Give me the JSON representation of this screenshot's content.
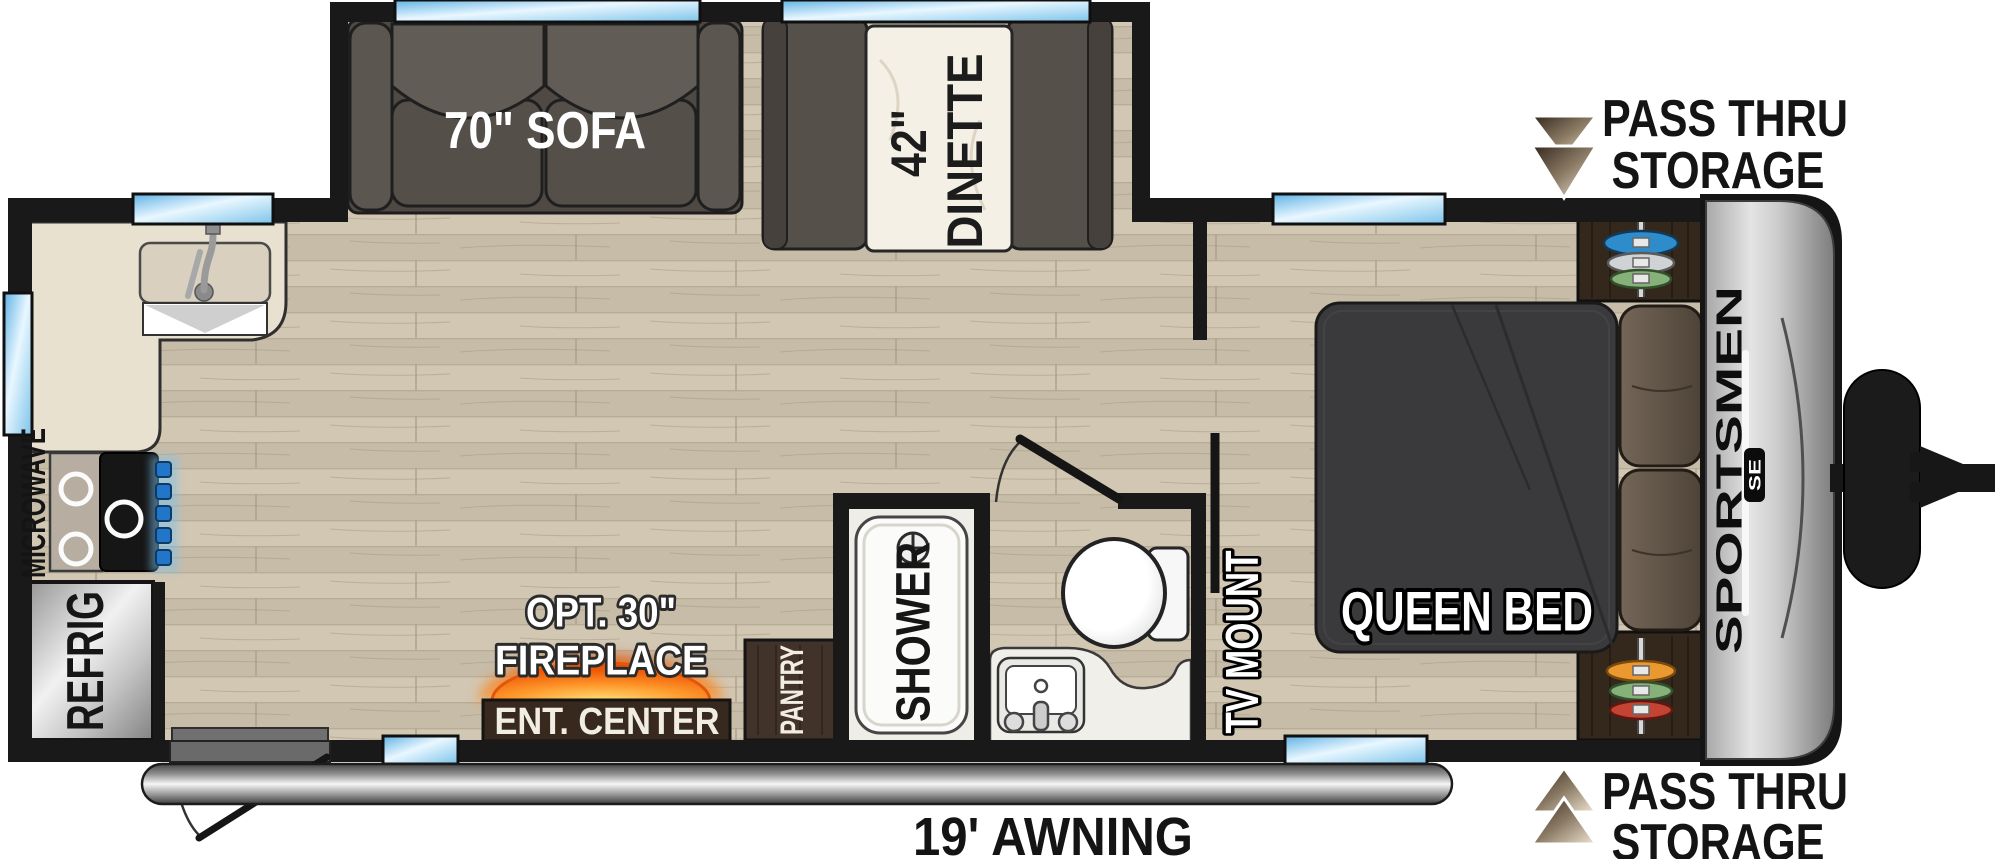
{
  "title": "Sportsmen SE Travel Trailer Floorplan",
  "labels": {
    "sofa": "70\" SOFA",
    "dinette_size": "42\"",
    "dinette_name": "DINETTE",
    "pass_thru_top_line1": "PASS THRU",
    "pass_thru_top_line2": "STORAGE",
    "pass_thru_bottom_line1": "PASS THRU",
    "pass_thru_bottom_line2": "STORAGE",
    "queen_bed": "QUEEN BED",
    "tv_mount": "TV MOUNT",
    "shower": "SHOWER",
    "pantry": "PANTRY",
    "fireplace_opt": "OPT. 30\"",
    "fireplace": "FIREPLACE",
    "ent_center": "ENT. CENTER",
    "microwave": "MICROWAVE",
    "refrigerator": "REFRIG",
    "brand": "SPORTSMEN",
    "brand_badge": "SE",
    "awning": "19' AWNING"
  },
  "colors": {
    "wall": "#191919",
    "floor_base": "#cdc2ae",
    "window_blue": "#7cc3ea",
    "furniture_gray": "#55504a",
    "cabinet_brown": "#3a2c1f",
    "bed_charcoal": "#3a3a3c",
    "fire_accent": "#f05a0a",
    "cap_silver": "#cfcfcf"
  }
}
